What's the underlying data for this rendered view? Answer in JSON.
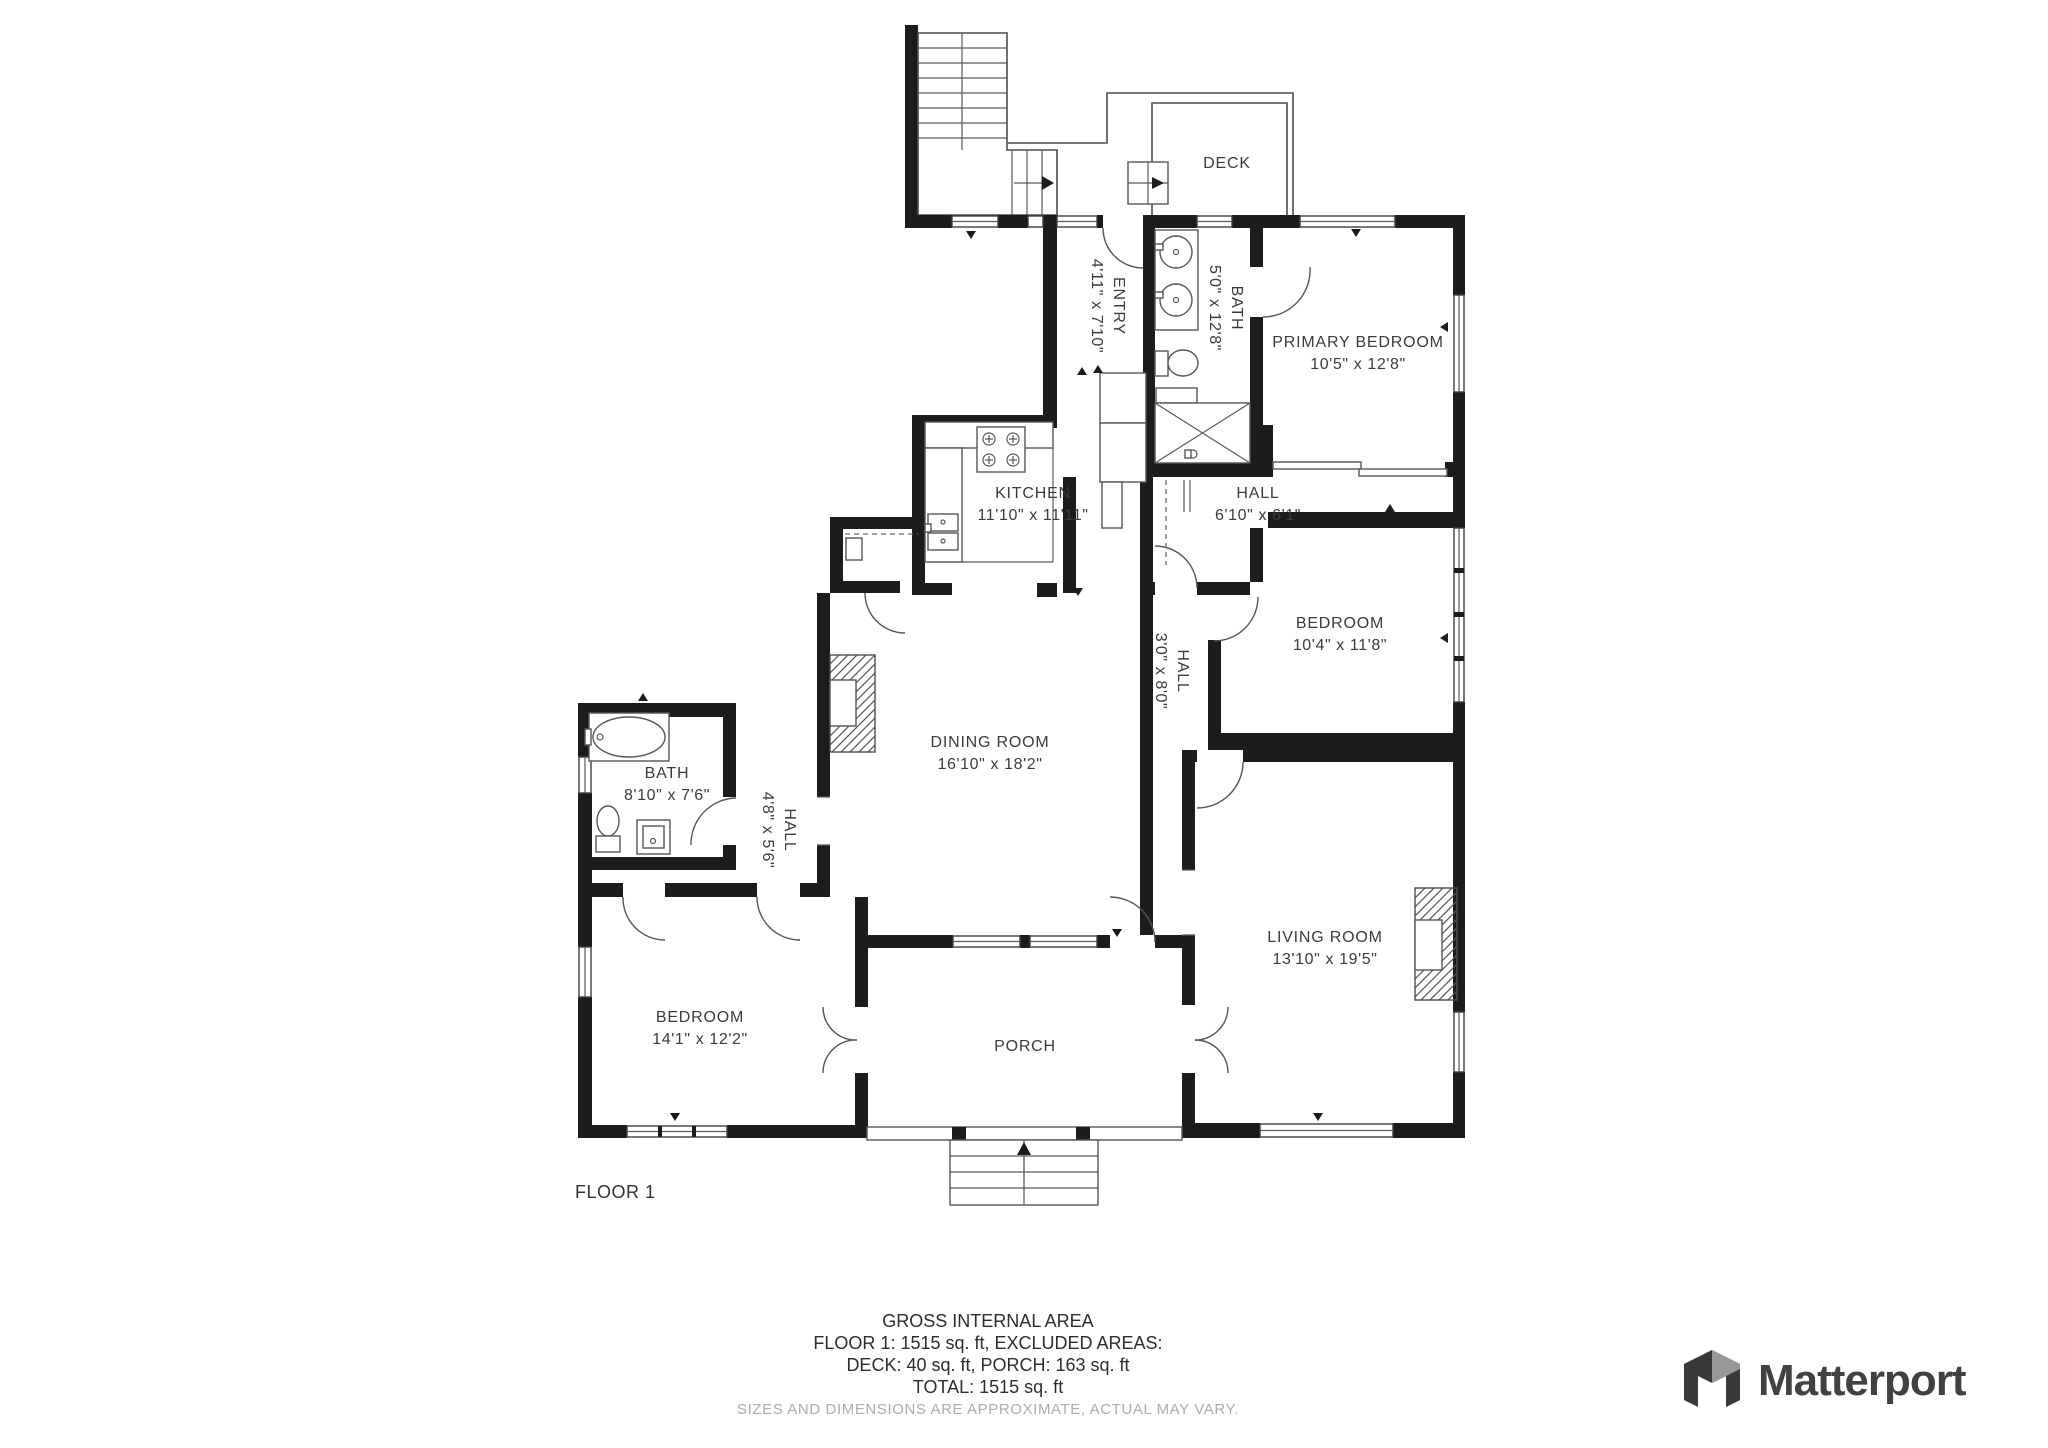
{
  "floor_label": "FLOOR 1",
  "rooms": [
    {
      "id": "deck",
      "name": "DECK",
      "dims": ""
    },
    {
      "id": "entry",
      "name": "ENTRY",
      "dims": "4'11\" x 7'10\""
    },
    {
      "id": "bath-upper",
      "name": "BATH",
      "dims": "5'0\" x 12'8\""
    },
    {
      "id": "primary-bedroom",
      "name": "PRIMARY BEDROOM",
      "dims": "10'5\" x 12'8\""
    },
    {
      "id": "kitchen",
      "name": "KITCHEN",
      "dims": "11'10\" x 11'11\""
    },
    {
      "id": "hall-upper",
      "name": "HALL",
      "dims": "6'10\" x 6'1\""
    },
    {
      "id": "bedroom-right",
      "name": "BEDROOM",
      "dims": "10'4\" x 11'8\""
    },
    {
      "id": "hall-mid",
      "name": "HALL",
      "dims": "3'0\" x 8'0\""
    },
    {
      "id": "dining-room",
      "name": "DINING ROOM",
      "dims": "16'10\" x 18'2\""
    },
    {
      "id": "bath-left",
      "name": "BATH",
      "dims": "8'10\" x 7'6\""
    },
    {
      "id": "hall-left",
      "name": "HALL",
      "dims": "4'8\" x 5'6\""
    },
    {
      "id": "bedroom-left",
      "name": "BEDROOM",
      "dims": "14'1\" x 12'2\""
    },
    {
      "id": "living-room",
      "name": "LIVING ROOM",
      "dims": "13'10\" x 19'5\""
    },
    {
      "id": "porch",
      "name": "PORCH",
      "dims": ""
    }
  ],
  "footer": {
    "line1": "GROSS INTERNAL AREA",
    "line2": "FLOOR 1: 1515 sq. ft, EXCLUDED AREAS:",
    "line3": "DECK: 40 sq. ft, PORCH: 163 sq. ft",
    "line4": "TOTAL: 1515 sq. ft",
    "disclaimer": "SIZES AND DIMENSIONS ARE APPROXIMATE, ACTUAL MAY VARY."
  },
  "brand": {
    "name": "Matterport"
  },
  "colors": {
    "wall": "#1c1c1e",
    "thin_line": "#4d4d50",
    "label_text": "#3b3b3e",
    "footer_text": "#2d2d30",
    "muted_text": "#adadb0",
    "logo_text": "#414144",
    "background": "#ffffff"
  }
}
